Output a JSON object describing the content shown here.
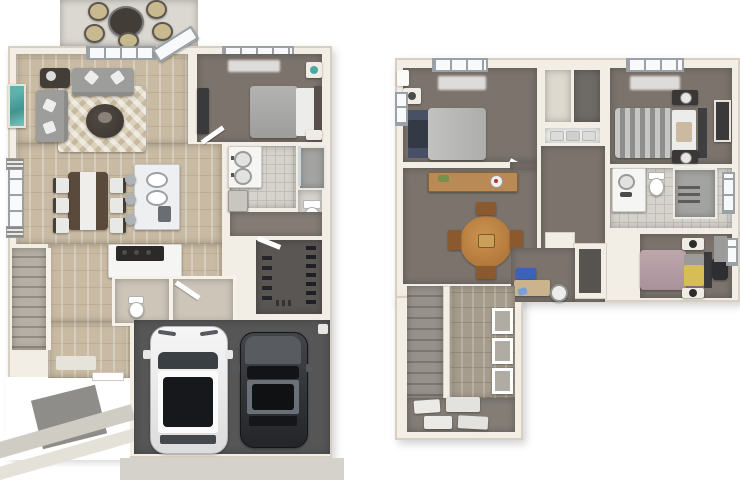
{
  "meta": {
    "type": "3d-floor-plan-rendering",
    "panels": 2
  },
  "palette": {
    "bg": "#ffffff",
    "wall": "#f2eee6",
    "wall_edge": "#d7d0c2",
    "wood": "#c8baa3",
    "wood2": "#a69c8d",
    "carpet": "#7b736c",
    "carpet2": "#847c75",
    "garage": "#565656",
    "closet_floor": "#5a5653",
    "tile": "#d6d3cd",
    "tile_line": "#c1beb7",
    "patio": "#dbd8d1",
    "driveway": "#d5d2cb",
    "rug": "#dcd2bc",
    "sofa": "#9d9d9c",
    "dark": "#433d38",
    "teal": "#4fa7a2",
    "island": "#edeff0",
    "counter": "#f5f5f3",
    "range": "#2b2a29",
    "bedgray": "#ababa9",
    "bedwhite": "#ececea",
    "stripe1": "#c6c6c4",
    "stripe2": "#8e8e8c",
    "mauve": "#b39aa1",
    "yellow": "#d6bd55",
    "oak": "#b9823f",
    "oak2": "#8a5a2e",
    "console": "#b98a56",
    "stair1": "#b5afa5",
    "stair2": "#938c80",
    "stair3": "#96918a",
    "stair4": "#7c766e",
    "white": "#ffffff",
    "glass": "#f7f9fa",
    "frame": "#9aa0a5",
    "navy": "#333a46",
    "blue": "#3a62b8",
    "blue2": "#7aa0d8",
    "shower": "#a3a3a1",
    "porch": "#8f8d89",
    "walk": "#cfccc4",
    "walk2": "#e4e1d9",
    "offwhite": "#efece6",
    "drkfurn": "#3a3a3c",
    "chairgray": "#aeb3b8",
    "desk": "#cbb38e",
    "carbody": "#3b3d40",
    "carroof": "#6a7077"
  },
  "floors": {
    "first": {
      "label": "first-floor-plan",
      "rooms": {
        "patio": "patio",
        "living": "living-room",
        "bedroom": "bedroom",
        "bath": "bathroom",
        "shower": "shower",
        "wc": "water-closet",
        "dining": "dining-area",
        "kitchen": "kitchen",
        "hall": "hallway",
        "stairs": "staircase",
        "powder": "powder-room",
        "mudroom": "mudroom",
        "closet": "walk-in-closet",
        "garage": "two-car-garage",
        "entry": "entry",
        "driveway": "driveway"
      },
      "furniture": [
        "outdoor-dining-set",
        "sectional-sofa",
        "round-ottoman",
        "area-rug",
        "dining-table-6-chairs",
        "kitchen-island-3-stools",
        "range",
        "double-vanity",
        "toilet",
        "queen-bed",
        "dresser",
        "shoe-shelves",
        "white-suv",
        "dark-sedan"
      ]
    },
    "second": {
      "label": "second-floor-plan",
      "rooms": {
        "bedroom2": "bedroom-2",
        "closets": "hall-closets",
        "linen": "linen-closet",
        "master": "master-bedroom",
        "loft": "loft",
        "hall": "hallway",
        "bath": "bathroom",
        "bedroom3": "bedroom-3",
        "desk_nook": "desk-nook",
        "storage": "storage-closet",
        "stairs": "staircase",
        "landing": "landing",
        "laundry": "laundry-area"
      },
      "furniture": [
        "gray-bed",
        "striped-bed",
        "mauve-bed-yellow-pillows",
        "round-table-4-chairs",
        "console-table",
        "writing-desk",
        "desk-chair",
        "vanity",
        "toilet",
        "glass-shower",
        "gallery-frames",
        "floor-mats"
      ]
    }
  }
}
